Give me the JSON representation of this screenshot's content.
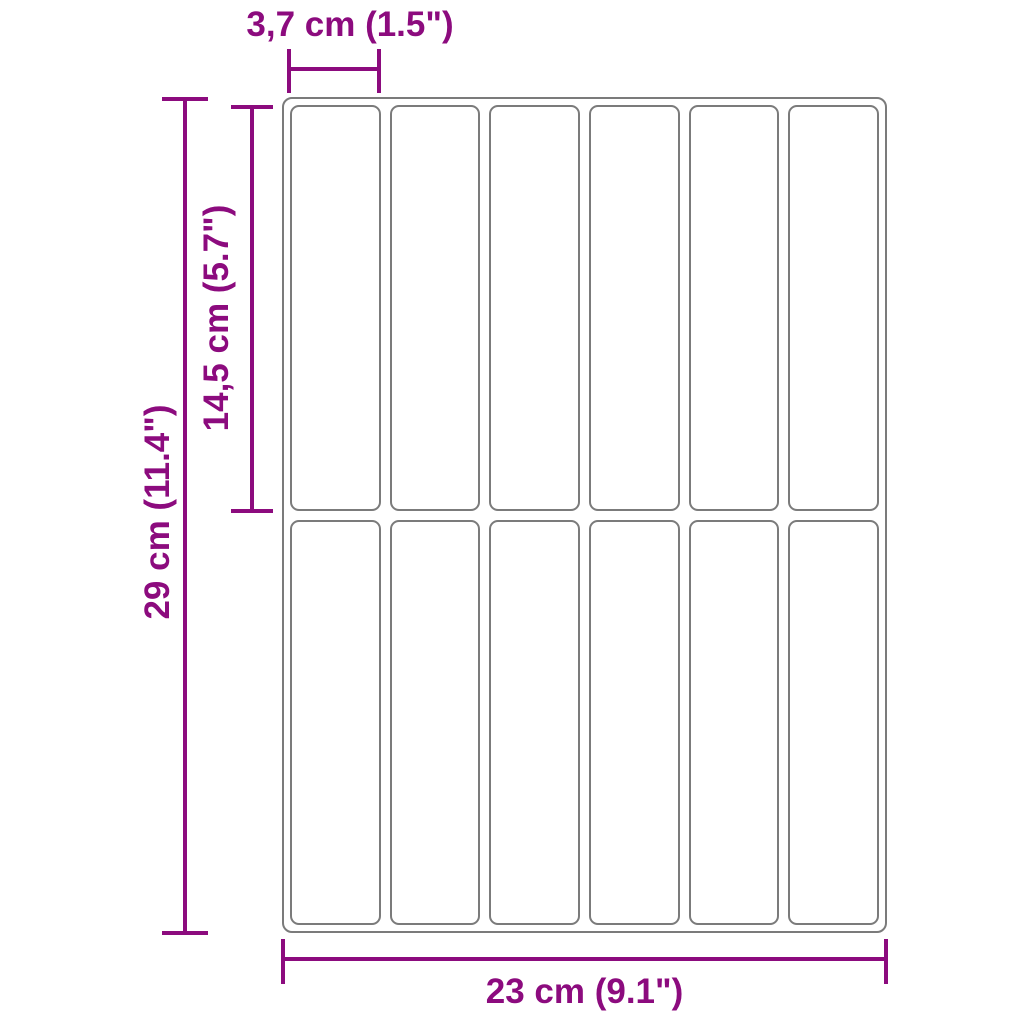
{
  "diagram": {
    "kind": "product-dimension-diagram",
    "grid": {
      "columns": 6,
      "rows": 2,
      "cells": 12
    },
    "dims": {
      "cell_width": "3,7 cm (1.5\")",
      "cell_height": "14,5 cm (5.7\")",
      "sheet_height": "29 cm (11.4\")",
      "sheet_width": "23 cm (9.1\")"
    },
    "colors": {
      "dimension": "#8C0B7E",
      "outline": "#7B7B7B",
      "background": "#FFFFFF"
    }
  }
}
